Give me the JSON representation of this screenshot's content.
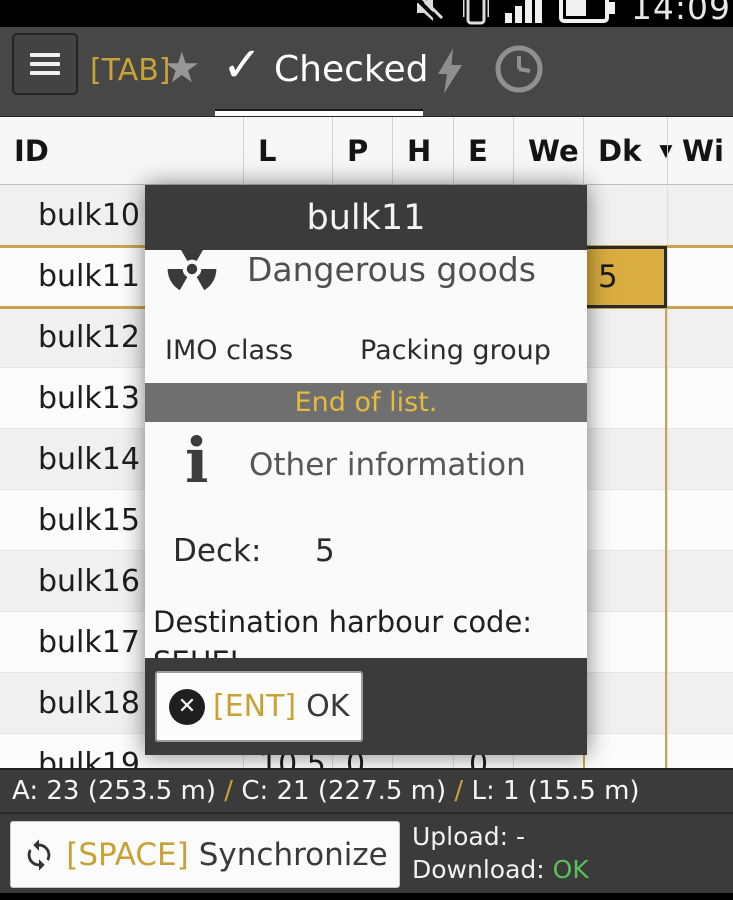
{
  "status_bar": {
    "time": "14:09"
  },
  "toolbar": {
    "tab_key": "[TAB]",
    "active_tab": "Checked"
  },
  "icons": {
    "star": "★",
    "check": "✓",
    "close_x": "✕",
    "dropdown_caret": "▼",
    "info": "i"
  },
  "table": {
    "columns": [
      "ID",
      "L",
      "P",
      "H",
      "E",
      "We",
      "Dk",
      "Wi"
    ],
    "sorted_column": "Dk",
    "rows": [
      {
        "id": "bulk10"
      },
      {
        "id": "bulk11",
        "selected": true,
        "values": {
          "Dk": "5"
        }
      },
      {
        "id": "bulk12"
      },
      {
        "id": "bulk13"
      },
      {
        "id": "bulk14"
      },
      {
        "id": "bulk15"
      },
      {
        "id": "bulk16"
      },
      {
        "id": "bulk17"
      },
      {
        "id": "bulk18"
      },
      {
        "id": "bulk19",
        "values": {
          "L": "10.5",
          "P": "0",
          "E": "0"
        }
      }
    ]
  },
  "dialog": {
    "title": "bulk11",
    "dangerous_goods": {
      "heading": "Dangerous goods",
      "imo_class_label": "IMO class",
      "packing_group_label": "Packing group"
    },
    "end_of_list": "End of list.",
    "other_info": {
      "heading": "Other information",
      "deck_label": "Deck:",
      "deck_value": "5",
      "destination_label": "Destination harbour code:",
      "destination_value": "SEHEL"
    },
    "ok_button": {
      "key": "[ENT]",
      "label": "OK"
    }
  },
  "summary": {
    "a": "A: 23 (253.5 m)",
    "slash1": " / ",
    "c": "C: 21 (227.5 m)",
    "slash2": " / ",
    "l": "L: 1 (15.5 m)"
  },
  "sync_bar": {
    "key": "[SPACE]",
    "label": "Synchronize",
    "upload_label": "Upload: ",
    "upload_value": "-",
    "download_label": "Download: ",
    "download_value": "OK"
  },
  "colors": {
    "accent_gold": "#c9a235",
    "selected_cell_gold": "#d9ad3f",
    "download_ok_green": "#58c05c"
  }
}
